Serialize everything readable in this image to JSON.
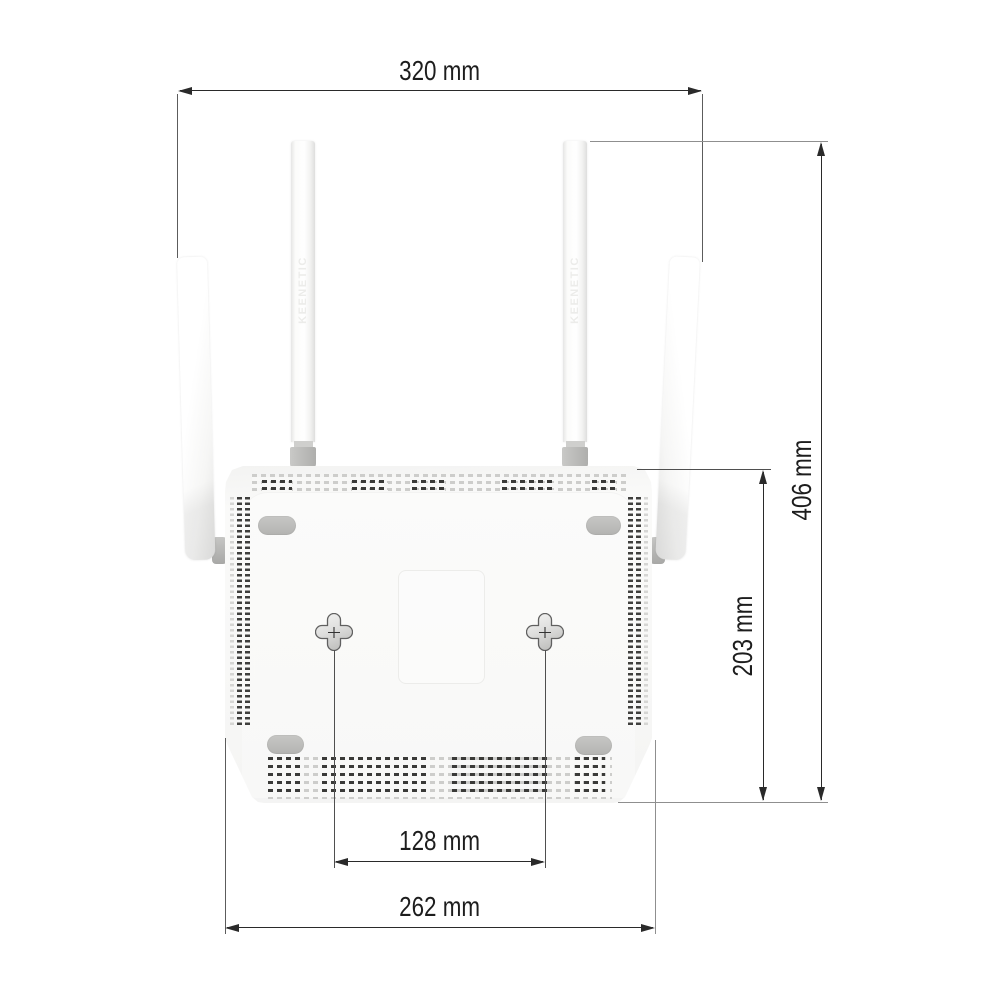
{
  "diagram_type": "product-dimension-drawing",
  "device": {
    "description": "wireless router rear/bottom view with four antennas",
    "brand_embossed": "KEENETIC"
  },
  "labels": {
    "width_top": "320 mm",
    "height_right": "406 mm",
    "mount_height_right": "203 mm",
    "hole_spacing_bottom": "128 mm",
    "width_bottom": "262 mm"
  },
  "colors": {
    "background": "#ffffff",
    "dimension_line": "#2a2a2a",
    "extension_line_gray": "#8f8f8f",
    "text": "#1d1d1d",
    "device_body": "#f8f8f7",
    "vent_dark": "#3a3a38",
    "vent_light": "#cdcdcb",
    "foot_gray": "#bcbcba"
  }
}
